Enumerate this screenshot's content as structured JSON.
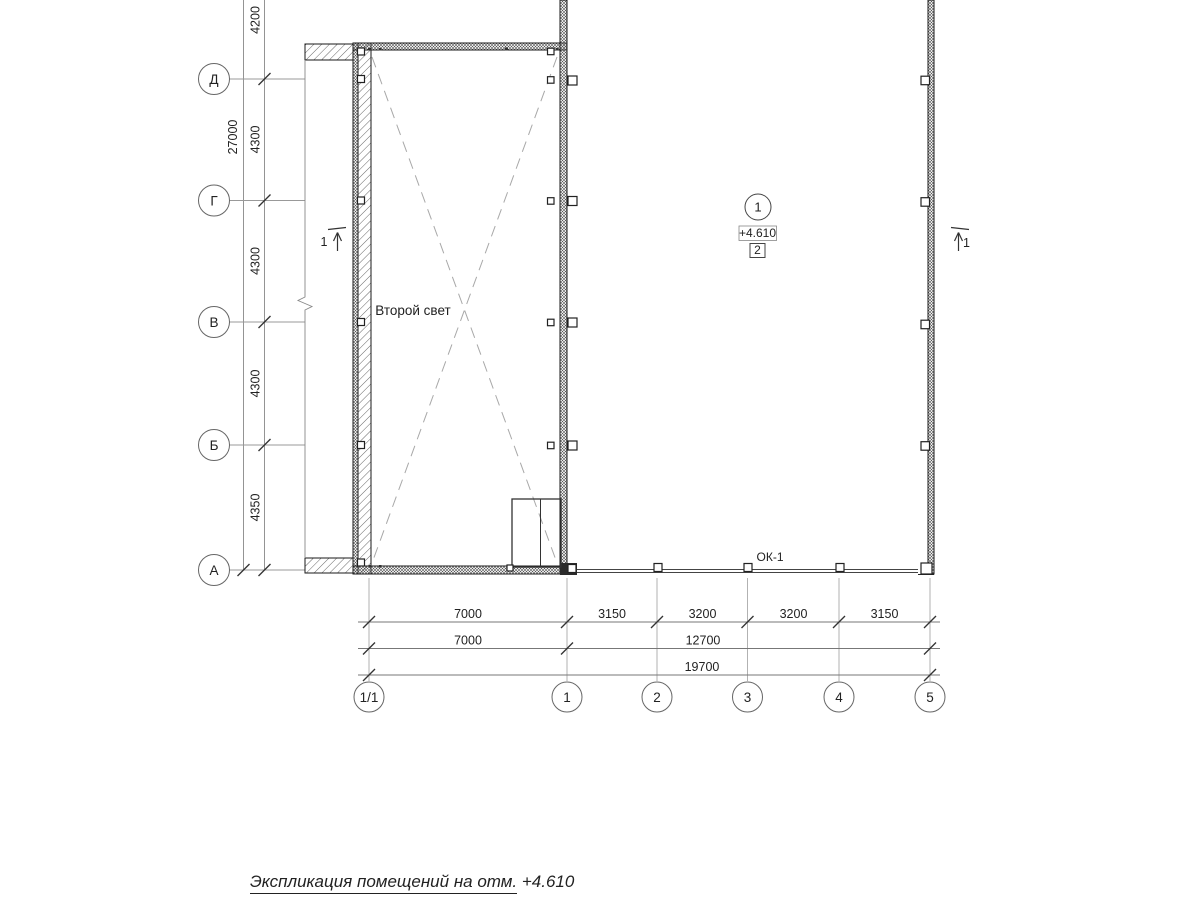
{
  "drawing": {
    "title": "Экспликация помещений на отм. +4.610",
    "room_label": "Второй свет",
    "window_tag": "ОК-1",
    "room_marker": {
      "number": "1",
      "elevation": "+4.610",
      "type_box": "2"
    },
    "section": {
      "left": "1",
      "right": "1"
    }
  },
  "axes": {
    "left": [
      "Д",
      "Г",
      "В",
      "Б",
      "А"
    ],
    "bottom": [
      "1/1",
      "1",
      "2",
      "3",
      "4",
      "5"
    ]
  },
  "dims": {
    "left_total": "27000",
    "left_segments": [
      "4200",
      "4300",
      "4300",
      "4300",
      "4350"
    ],
    "bottom_row1": [
      "7000",
      "3150",
      "3200",
      "3200",
      "3150"
    ],
    "bottom_row2": [
      "7000",
      "12700"
    ],
    "bottom_total": "19700"
  },
  "colors": {
    "background": "#ffffff",
    "wall_line": "#1a1a1a",
    "thin_line": "#888888",
    "dash_line": "#a8a8a8",
    "text": "#222222"
  }
}
